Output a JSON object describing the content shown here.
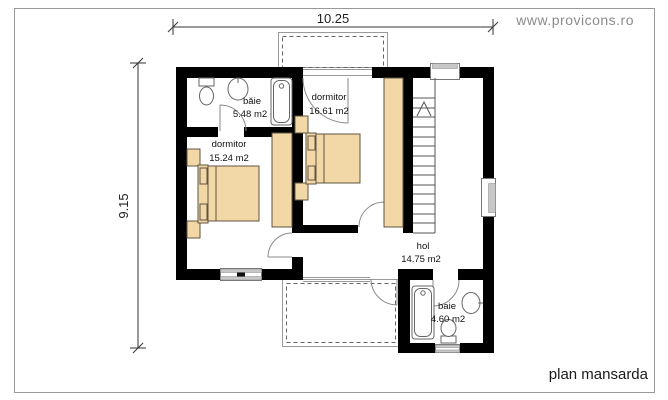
{
  "page": {
    "website": "www.provicons.ro",
    "plan_title": "plan mansarda"
  },
  "dimensions": {
    "width": "10.25",
    "height": "9.15"
  },
  "rooms": [
    {
      "name": "băie",
      "area": "5.48 m2"
    },
    {
      "name": "dormitor",
      "area": "16.61 m2"
    },
    {
      "name": "dormitor",
      "area": "15.24 m2"
    },
    {
      "name": "hol",
      "area": "14.75 m2"
    },
    {
      "name": "baie",
      "area": "4.60 m2"
    }
  ],
  "colors": {
    "wall": "#000000",
    "furniture": "#f2d8a6",
    "furniture_outline": "#5f5342",
    "text_muted": "#8b8b8b"
  }
}
